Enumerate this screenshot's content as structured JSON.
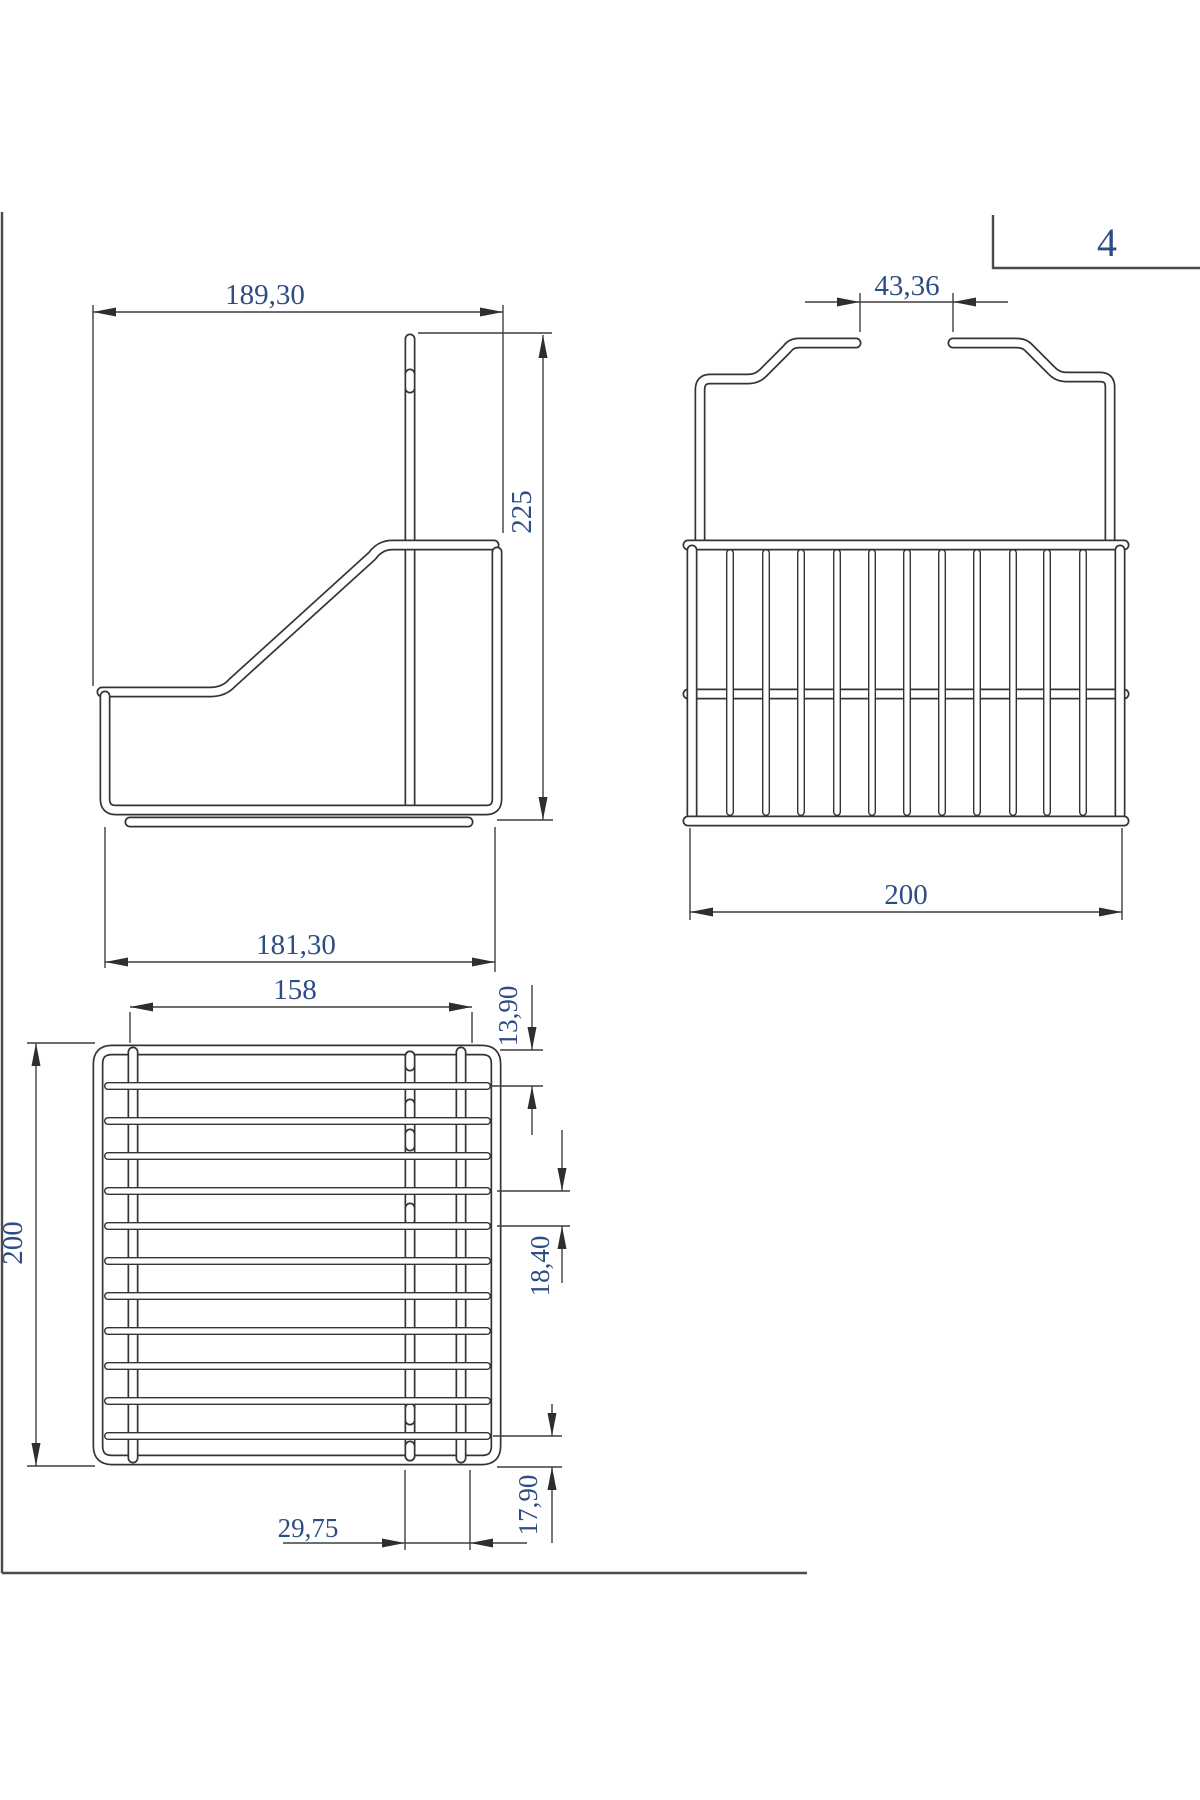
{
  "sheet": {
    "page_number": "4"
  },
  "colors": {
    "wire_line": "#343434",
    "dim_line": "#3f3f3f",
    "arrow": "#2e2e2e",
    "dim_text": "#2f4d85",
    "border": "#4a4a4a",
    "background": "#ffffff"
  },
  "side_view": {
    "description": "side elevation of wire basket with hanging hook",
    "dims": {
      "overall_width": "189,30",
      "overall_height": "225",
      "base_depth": "181,30"
    }
  },
  "front_view": {
    "description": "front elevation with hanger crown and vertical bars",
    "bar_count": 11,
    "dims": {
      "hook_gap": "43,36",
      "overall_width": "200"
    }
  },
  "top_view": {
    "description": "plan view with horizontal wires",
    "wire_count": 11,
    "dims": {
      "inner_width": "158",
      "overall_depth": "200",
      "first_wire_offset": "13,90",
      "wire_pitch": "18,40",
      "center_wire_offset": "29,75",
      "edge_wire_offset": "17,90"
    }
  }
}
